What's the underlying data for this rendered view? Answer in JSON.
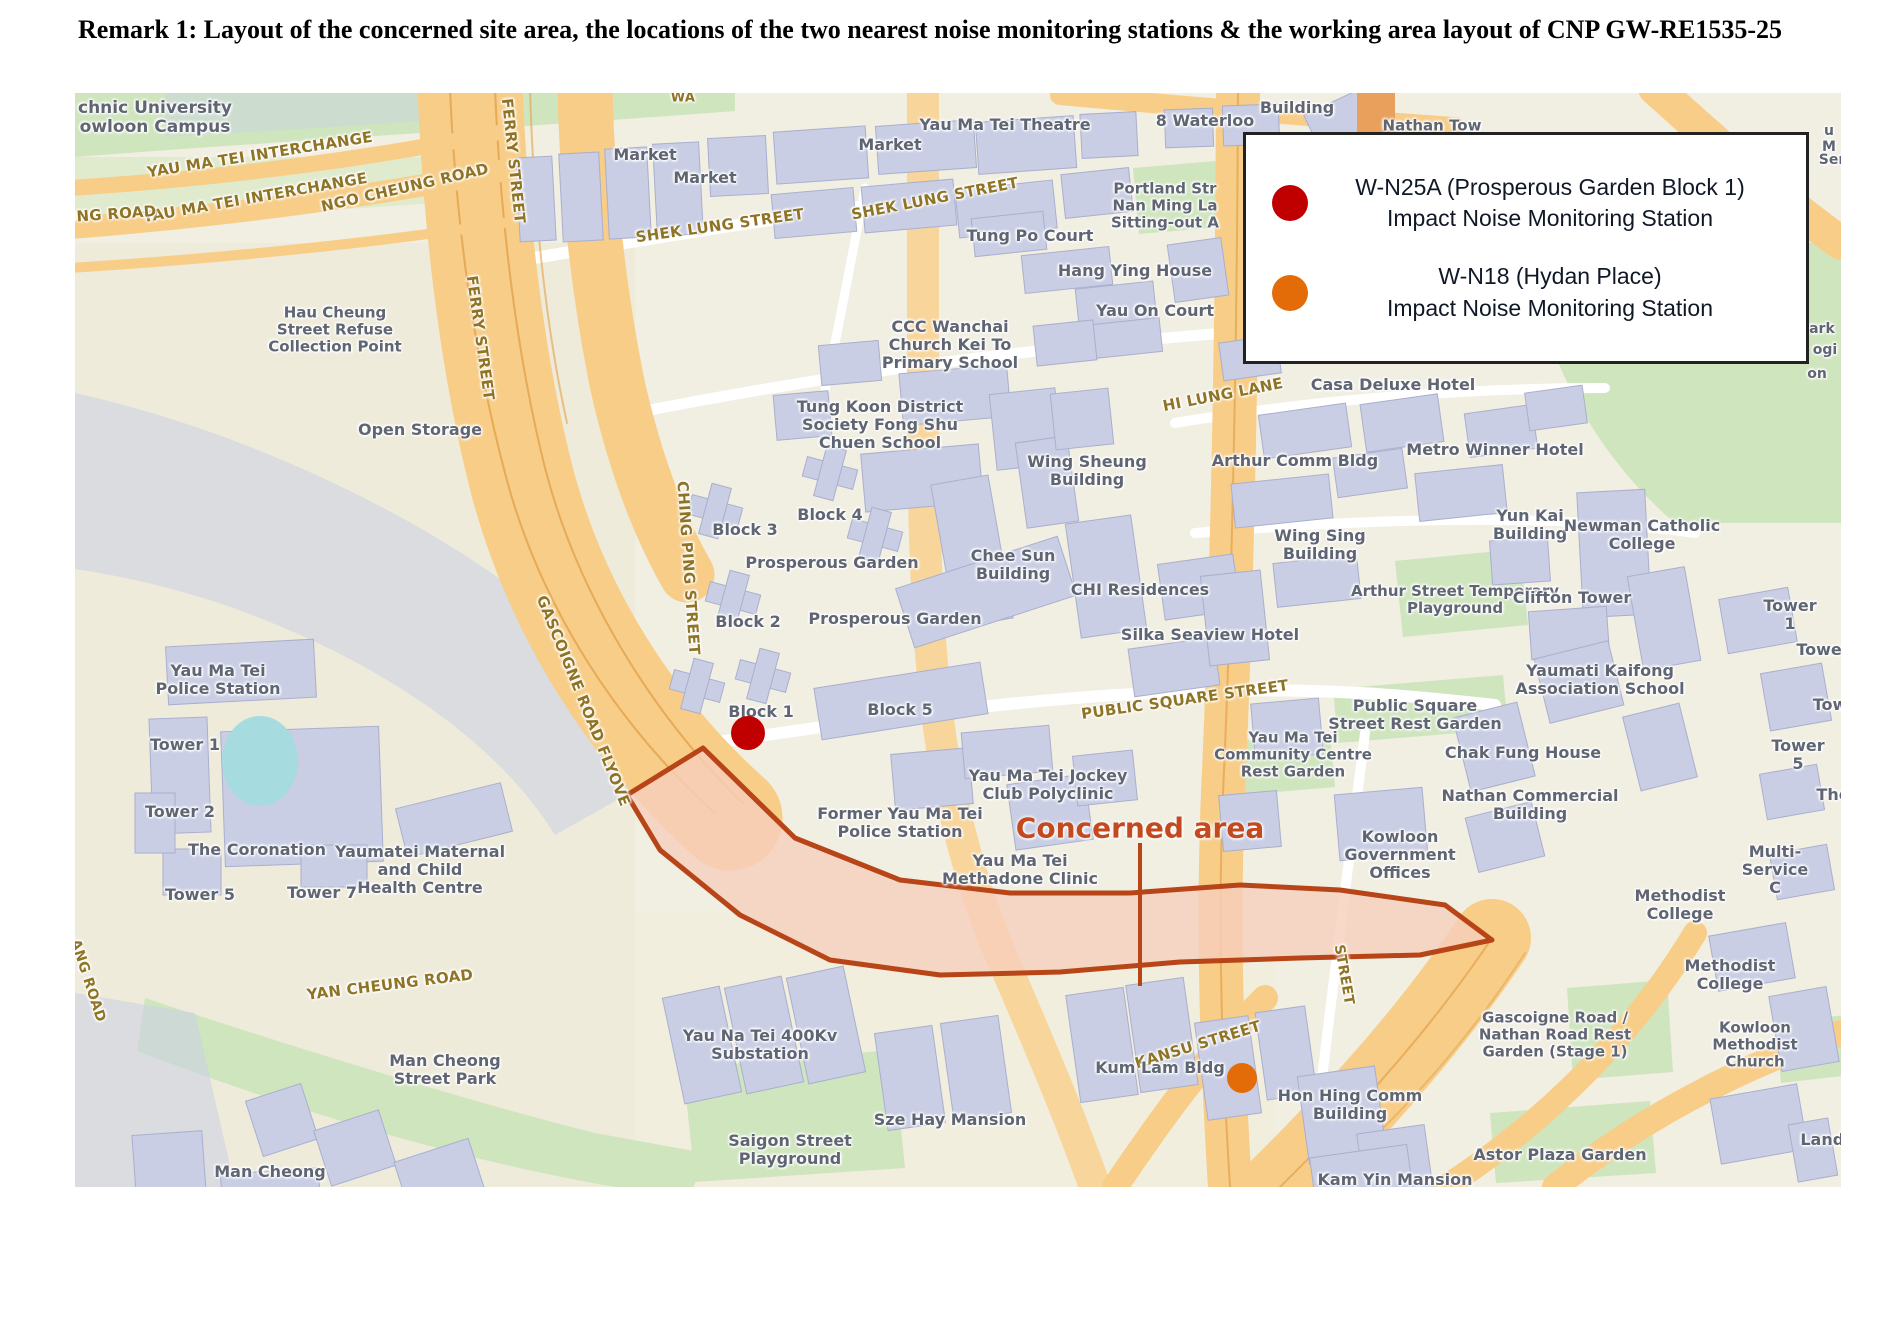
{
  "title": {
    "text": "Remark 1: Layout of the concerned site area, the locations of the two nearest noise monitoring stations & the working area layout of CNP GW-RE1535-25"
  },
  "legend": {
    "items": [
      {
        "id": "W-N25A",
        "marker_color": "#C00000",
        "line1": "W-N25A (Prosperous Garden Block 1)",
        "line2": "Impact Noise Monitoring Station"
      },
      {
        "id": "W-N18",
        "marker_color": "#E36C09",
        "line1": "W-N18 (Hydan Place)",
        "line2": "Impact Noise Monitoring Station"
      }
    ]
  },
  "concerned_area": {
    "label": "Concerned area",
    "label_color": "#C34A1E",
    "outline_color": "#B84518",
    "fill_color": "#F6CEBC"
  },
  "markers": [
    {
      "id": "W-N25A",
      "name": "Prosperous Garden Block 1 station",
      "color": "#C00000",
      "x": 673,
      "y": 640,
      "r": 17
    },
    {
      "id": "W-N18",
      "name": "Hydan Place station",
      "color": "#E36C09",
      "x": 1167,
      "y": 985,
      "r": 15
    }
  ],
  "map": {
    "labels": [
      {
        "t": "chnic University\nowloon Campus",
        "x": 80,
        "y": 25,
        "s": 17
      },
      {
        "t": "YAU MA TEI INTERCHANGE",
        "x": 185,
        "y": 62,
        "r": -9,
        "c": "road",
        "s": 15
      },
      {
        "t": "YAU MA TEI INTERCHANGE",
        "x": 180,
        "y": 105,
        "r": -10,
        "c": "road",
        "s": 15
      },
      {
        "t": "EUNG ROAD",
        "x": 30,
        "y": 122,
        "r": -4,
        "c": "road",
        "s": 15
      },
      {
        "t": "NGO CHEUNG ROAD",
        "x": 330,
        "y": 95,
        "r": -13,
        "c": "road",
        "s": 15
      },
      {
        "t": "FERRY STREET",
        "x": 438,
        "y": 68,
        "r": 84,
        "c": "road",
        "s": 15
      },
      {
        "t": "FERRY STREET",
        "x": 405,
        "y": 245,
        "r": 82,
        "c": "road",
        "s": 15
      },
      {
        "t": "WA",
        "x": 608,
        "y": 6,
        "c": "road",
        "s": 13
      },
      {
        "t": "Market",
        "x": 570,
        "y": 62,
        "s": 16
      },
      {
        "t": "Market",
        "x": 630,
        "y": 85,
        "s": 16
      },
      {
        "t": "Market",
        "x": 815,
        "y": 52,
        "s": 16
      },
      {
        "t": "Yau Ma Tei Theatre",
        "x": 930,
        "y": 32,
        "s": 16
      },
      {
        "t": "8 Waterloo",
        "x": 1130,
        "y": 28,
        "s": 16
      },
      {
        "t": "Building",
        "x": 1222,
        "y": 15,
        "s": 16
      },
      {
        "t": "Nathan Tow",
        "x": 1357,
        "y": 33,
        "s": 15
      },
      {
        "t": "SHEK LUNG STREET",
        "x": 645,
        "y": 133,
        "r": -8,
        "c": "road",
        "s": 15
      },
      {
        "t": "SHEK LUNG STREET",
        "x": 860,
        "y": 106,
        "r": -11,
        "c": "road",
        "s": 15
      },
      {
        "t": "Portland Str\nNan Ming La\nSitting-out A",
        "x": 1090,
        "y": 113,
        "s": 15
      },
      {
        "t": "Tung Po Court",
        "x": 955,
        "y": 143,
        "s": 16
      },
      {
        "t": "Hang Ying House",
        "x": 1060,
        "y": 178,
        "s": 16
      },
      {
        "t": "Yau On Court",
        "x": 1080,
        "y": 218,
        "s": 16
      },
      {
        "t": "Hau Cheung\nStreet Refuse\nCollection Point",
        "x": 260,
        "y": 237,
        "s": 15
      },
      {
        "t": "CCC Wanchai\nChurch Kei To\nPrimary School",
        "x": 875,
        "y": 252,
        "s": 16
      },
      {
        "t": "HI LUNG LANE",
        "x": 1148,
        "y": 302,
        "r": -11,
        "c": "road",
        "s": 15
      },
      {
        "t": "Casa Deluxe Hotel",
        "x": 1318,
        "y": 292,
        "s": 16
      },
      {
        "t": "Open Storage",
        "x": 345,
        "y": 337,
        "s": 16
      },
      {
        "t": "Tung Koon District\nSociety Fong Shu\nChuen School",
        "x": 805,
        "y": 332,
        "s": 16
      },
      {
        "t": "Wing Sheung\nBuilding",
        "x": 1012,
        "y": 378,
        "s": 16
      },
      {
        "t": "Arthur Comm Bldg",
        "x": 1220,
        "y": 368,
        "s": 16
      },
      {
        "t": "Metro Winner Hotel",
        "x": 1420,
        "y": 357,
        "s": 16
      },
      {
        "t": "u M",
        "x": 1754,
        "y": 47,
        "s": 14
      },
      {
        "t": "Ser",
        "x": 1757,
        "y": 68,
        "s": 14
      },
      {
        "t": "Park",
        "x": 1742,
        "y": 237,
        "s": 14
      },
      {
        "t": "ogi",
        "x": 1750,
        "y": 258,
        "s": 14
      },
      {
        "t": "on",
        "x": 1742,
        "y": 282,
        "s": 14
      },
      {
        "t": "CHING PING STREET",
        "x": 613,
        "y": 475,
        "r": 86,
        "c": "road",
        "s": 15
      },
      {
        "t": "Block 3",
        "x": 670,
        "y": 437,
        "s": 16
      },
      {
        "t": "Block 4",
        "x": 755,
        "y": 422,
        "s": 16
      },
      {
        "t": "Prosperous Garden",
        "x": 757,
        "y": 470,
        "s": 16
      },
      {
        "t": "Chee Sun\nBuilding",
        "x": 938,
        "y": 472,
        "s": 16
      },
      {
        "t": "Wing Sing\nBuilding",
        "x": 1245,
        "y": 452,
        "s": 16
      },
      {
        "t": "Yun Kai\nBuilding",
        "x": 1455,
        "y": 432,
        "s": 16
      },
      {
        "t": "Newman Catholic\nCollege",
        "x": 1567,
        "y": 442,
        "s": 16
      },
      {
        "t": "CHI Residences",
        "x": 1065,
        "y": 497,
        "s": 16
      },
      {
        "t": "Arthur Street Temporary\nPlayground",
        "x": 1380,
        "y": 507,
        "s": 15
      },
      {
        "t": "Clifton Tower",
        "x": 1497,
        "y": 505,
        "s": 16
      },
      {
        "t": "Tower 1",
        "x": 1715,
        "y": 522,
        "s": 16
      },
      {
        "t": "Block 2",
        "x": 673,
        "y": 529,
        "s": 16
      },
      {
        "t": "Prosperous Garden",
        "x": 820,
        "y": 526,
        "s": 16
      },
      {
        "t": "Silka Seaview Hotel",
        "x": 1135,
        "y": 542,
        "s": 16
      },
      {
        "t": "Tower",
        "x": 1748,
        "y": 557,
        "s": 16
      },
      {
        "t": "Yaumati Kaifong\nAssociation School",
        "x": 1525,
        "y": 587,
        "s": 16
      },
      {
        "t": "Yau Ma Tei\nPolice Station",
        "x": 143,
        "y": 587,
        "s": 16
      },
      {
        "t": "Block 1",
        "x": 686,
        "y": 619,
        "s": 16
      },
      {
        "t": "Block 5",
        "x": 825,
        "y": 617,
        "s": 16
      },
      {
        "t": "PUBLIC SQUARE STREET",
        "x": 1110,
        "y": 607,
        "r": -8,
        "c": "road",
        "s": 15
      },
      {
        "t": "Public Square\nStreet Rest Garden",
        "x": 1340,
        "y": 622,
        "s": 16
      },
      {
        "t": "Tow",
        "x": 1755,
        "y": 612,
        "s": 16
      },
      {
        "t": "Yau Ma Tei\nCommunity Centre\nRest Garden",
        "x": 1218,
        "y": 662,
        "s": 15
      },
      {
        "t": "Chak Fung House",
        "x": 1448,
        "y": 660,
        "s": 16
      },
      {
        "t": "Tower 5",
        "x": 1723,
        "y": 662,
        "s": 16
      },
      {
        "t": "Yau Ma Tei Jockey\nClub Polyclinic",
        "x": 973,
        "y": 692,
        "s": 16
      },
      {
        "t": "Former Yau Ma Tei\nPolice Station",
        "x": 825,
        "y": 730,
        "s": 16
      },
      {
        "t": "Nathan Commercial\nBuilding",
        "x": 1455,
        "y": 712,
        "s": 16
      },
      {
        "t": "The",
        "x": 1758,
        "y": 702,
        "s": 16
      },
      {
        "t": "Tower 1",
        "x": 110,
        "y": 652,
        "s": 16
      },
      {
        "t": "Tower 2",
        "x": 105,
        "y": 719,
        "s": 16
      },
      {
        "t": "The Coronation",
        "x": 182,
        "y": 757,
        "s": 16
      },
      {
        "t": "Yaumatei Maternal\nand Child\nHealth Centre",
        "x": 345,
        "y": 777,
        "s": 16
      },
      {
        "t": "Tower 5",
        "x": 125,
        "y": 802,
        "s": 16
      },
      {
        "t": "Tower 7",
        "x": 247,
        "y": 800,
        "s": 16
      },
      {
        "t": "Yau Ma Tei\nMethadone Clinic",
        "x": 945,
        "y": 777,
        "s": 16
      },
      {
        "t": "Kowloon\nGovernment\nOffices",
        "x": 1325,
        "y": 762,
        "s": 16
      },
      {
        "t": "Multi-Service C",
        "x": 1700,
        "y": 777,
        "s": 16
      },
      {
        "t": "Methodist College",
        "x": 1605,
        "y": 812,
        "s": 16
      },
      {
        "t": "GASCOIGNE ROAD FLYOVE",
        "x": 508,
        "y": 608,
        "r": 68,
        "c": "road",
        "s": 15
      },
      {
        "t": "STREET",
        "x": 1268,
        "y": 882,
        "r": 80,
        "c": "road",
        "s": 14
      },
      {
        "t": "ANG ROAD",
        "x": 12,
        "y": 888,
        "r": 72,
        "c": "road",
        "s": 14
      },
      {
        "t": "YAN CHEUNG ROAD",
        "x": 315,
        "y": 892,
        "r": -7,
        "c": "road",
        "s": 15
      },
      {
        "t": "Man Cheong\nStreet Park",
        "x": 370,
        "y": 977,
        "s": 16
      },
      {
        "t": "Man Cheong",
        "x": 195,
        "y": 1079,
        "s": 16
      },
      {
        "t": "Methodist College",
        "x": 1655,
        "y": 882,
        "s": 16
      },
      {
        "t": "KANSU STREET",
        "x": 1123,
        "y": 952,
        "r": -17,
        "c": "road",
        "s": 15
      },
      {
        "t": "Yau Na Tei 400Kv\nSubstation",
        "x": 685,
        "y": 952,
        "s": 16
      },
      {
        "t": "Kum Lam Bldg",
        "x": 1085,
        "y": 975,
        "s": 16
      },
      {
        "t": "Hon Hing Comm\nBuilding",
        "x": 1275,
        "y": 1012,
        "s": 16
      },
      {
        "t": "Gascoigne Road /\nNathan Road Rest\nGarden (Stage 1)",
        "x": 1480,
        "y": 942,
        "s": 15
      },
      {
        "t": "Kowloon\nMethodist\nChurch",
        "x": 1680,
        "y": 952,
        "s": 15
      },
      {
        "t": "Sze Hay Mansion",
        "x": 875,
        "y": 1027,
        "s": 16
      },
      {
        "t": "Saigon Street\nPlayground",
        "x": 715,
        "y": 1057,
        "s": 16
      },
      {
        "t": "Astor Plaza Garden",
        "x": 1485,
        "y": 1062,
        "s": 16
      },
      {
        "t": "Kam Yin Mansion",
        "x": 1320,
        "y": 1087,
        "s": 16
      },
      {
        "t": "Lands",
        "x": 1752,
        "y": 1047,
        "s": 16
      }
    ]
  }
}
